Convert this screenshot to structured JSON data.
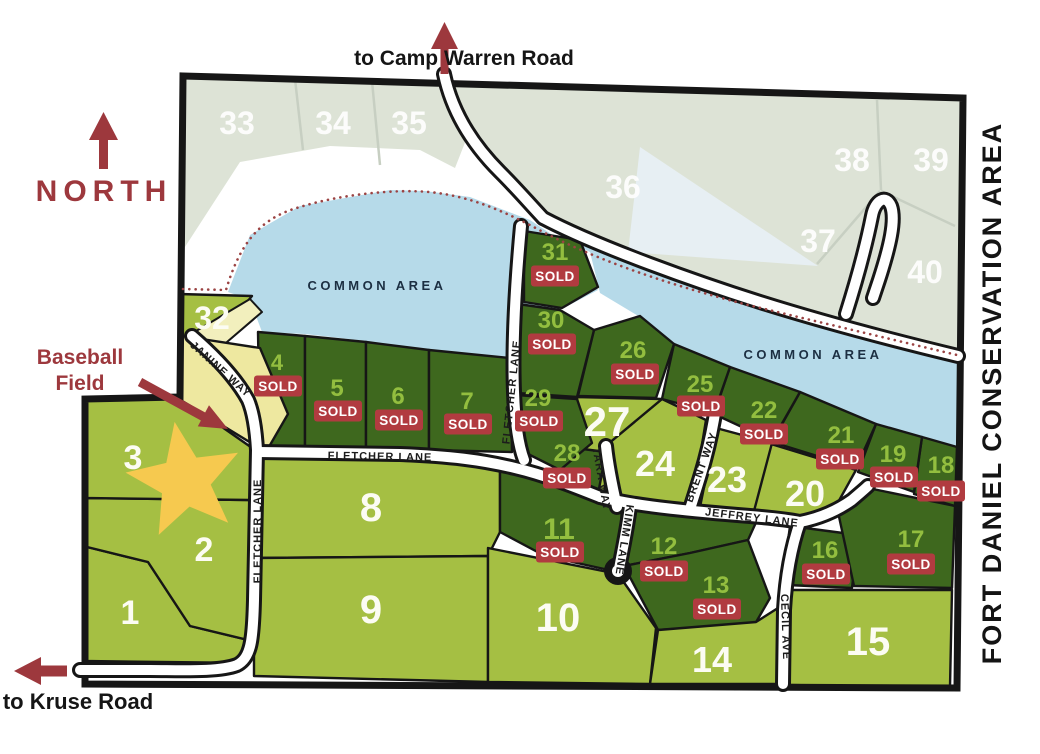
{
  "labels": {
    "north": "NORTH",
    "to_camp_warren": "to Camp Warren Road",
    "to_kruse": "to Kruse Road",
    "baseball_1": "Baseball",
    "baseball_2": "Field",
    "conservation": "FORT DANIEL CONSERVATION AREA",
    "common_area": "COMMON AREA",
    "sold": "SOLD"
  },
  "streets": {
    "fletcher": "FLETCHER LANE",
    "janine": "JANINE WAY",
    "tara": "TARA WAY",
    "brent": "BRENT WAY",
    "kimm": "KIMM LANE",
    "jeffrey": "JEFFREY LANE",
    "cecil": "CECIL AVE"
  },
  "lots": [
    {
      "number": "1",
      "status": "available"
    },
    {
      "number": "2",
      "status": "available"
    },
    {
      "number": "3",
      "status": "available"
    },
    {
      "number": "4",
      "status": "sold"
    },
    {
      "number": "5",
      "status": "sold"
    },
    {
      "number": "6",
      "status": "sold"
    },
    {
      "number": "7",
      "status": "sold"
    },
    {
      "number": "8",
      "status": "available"
    },
    {
      "number": "9",
      "status": "available"
    },
    {
      "number": "10",
      "status": "available"
    },
    {
      "number": "11",
      "status": "sold"
    },
    {
      "number": "12",
      "status": "sold"
    },
    {
      "number": "13",
      "status": "sold"
    },
    {
      "number": "14",
      "status": "available"
    },
    {
      "number": "15",
      "status": "available"
    },
    {
      "number": "16",
      "status": "sold"
    },
    {
      "number": "17",
      "status": "sold"
    },
    {
      "number": "18",
      "status": "sold"
    },
    {
      "number": "19",
      "status": "sold"
    },
    {
      "number": "20",
      "status": "available"
    },
    {
      "number": "21",
      "status": "sold"
    },
    {
      "number": "22",
      "status": "sold"
    },
    {
      "number": "23",
      "status": "available"
    },
    {
      "number": "24",
      "status": "available"
    },
    {
      "number": "25",
      "status": "sold"
    },
    {
      "number": "26",
      "status": "sold"
    },
    {
      "number": "27",
      "status": "available"
    },
    {
      "number": "28",
      "status": "sold"
    },
    {
      "number": "29",
      "status": "sold"
    },
    {
      "number": "30",
      "status": "sold"
    },
    {
      "number": "31",
      "status": "sold"
    },
    {
      "number": "32",
      "status": "available"
    },
    {
      "number": "33",
      "status": "future"
    },
    {
      "number": "34",
      "status": "future"
    },
    {
      "number": "35",
      "status": "future"
    },
    {
      "number": "36",
      "status": "future"
    },
    {
      "number": "37",
      "status": "future"
    },
    {
      "number": "38",
      "status": "future"
    },
    {
      "number": "39",
      "status": "future"
    },
    {
      "number": "40",
      "status": "future"
    }
  ],
  "colors": {
    "lot_available": "#a5bf43",
    "lot_sold": "#3e681e",
    "lot_future": "#dde3d6",
    "water": "#b6dae9",
    "road": "#ffffff",
    "outline": "#161616",
    "sold_badge": "#b13b40",
    "accent_red": "#9d383d",
    "star_yellow": "#f6c94f",
    "field_yellow": "#eee8a0",
    "shore_dotted": "#9b4343"
  }
}
